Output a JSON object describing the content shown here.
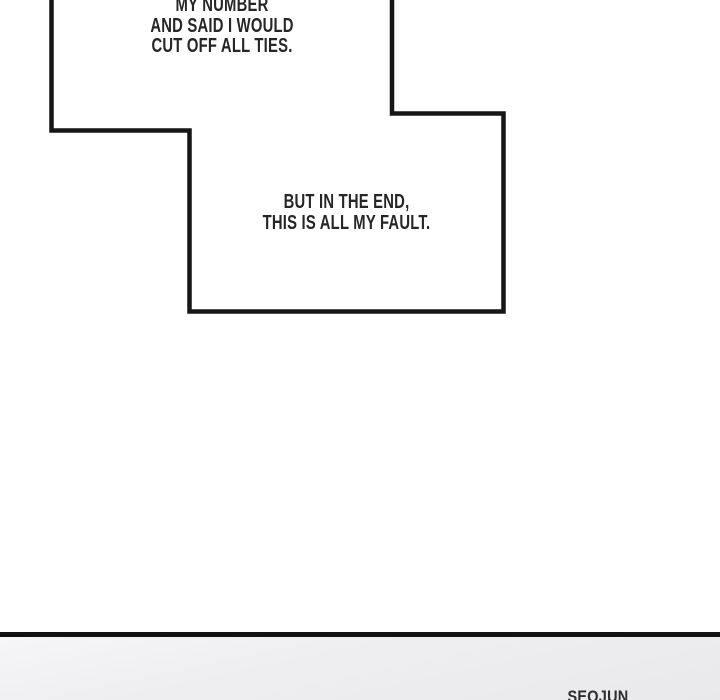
{
  "panel": {
    "type": "comic-page-segment",
    "bubble1": {
      "line1": "MY NUMBER",
      "line2": "AND SAID I WOULD",
      "line3": "CUT OFF ALL TIES."
    },
    "bubble2": {
      "line1": "BUT IN THE END,",
      "line2": "THIS IS ALL MY FAULT."
    },
    "next_panel": {
      "caption": "SEOJUN"
    },
    "colors": {
      "background": "#ffffff",
      "bubble_fill": "#ffffff",
      "bubble_outline": "#161616",
      "text": "#262626",
      "divider": "#121212",
      "next_panel_bg": "#ededef"
    }
  }
}
